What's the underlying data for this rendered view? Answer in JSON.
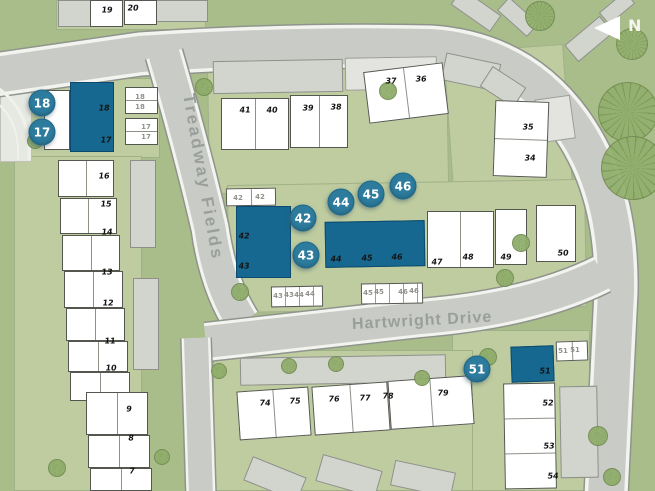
{
  "map": {
    "north": {
      "label": "N"
    },
    "colors": {
      "highlight_plot": "#176890",
      "badge": "#2d7c9e",
      "road": "#c9cbc6",
      "open_green": "#a8bd89",
      "parcel_green": "#becca0",
      "building_white": "#ffffff",
      "building_gray": "#d2d4ce"
    },
    "streets": [
      {
        "name": "Treadway Fields",
        "x": 188,
        "y": 84,
        "rotate": 80,
        "cls": "st-vert"
      },
      {
        "name": "Hartwright Drive",
        "x": 352,
        "y": 316,
        "rotate": -3,
        "cls": "st-horiz"
      }
    ],
    "badges": [
      {
        "label": "18",
        "x": 42,
        "y": 103
      },
      {
        "label": "17",
        "x": 42,
        "y": 132
      },
      {
        "label": "42",
        "x": 303,
        "y": 218
      },
      {
        "label": "43",
        "x": 306,
        "y": 255
      },
      {
        "label": "44",
        "x": 341,
        "y": 202
      },
      {
        "label": "45",
        "x": 371,
        "y": 194
      },
      {
        "label": "46",
        "x": 403,
        "y": 186
      },
      {
        "label": "51",
        "x": 477,
        "y": 369
      }
    ],
    "plot_labels": [
      {
        "label": "19",
        "x": 107,
        "y": 10
      },
      {
        "label": "20",
        "x": 133,
        "y": 8
      },
      {
        "label": "18",
        "x": 104,
        "y": 108
      },
      {
        "label": "17",
        "x": 106,
        "y": 140
      },
      {
        "label": "16",
        "x": 104,
        "y": 176
      },
      {
        "label": "15",
        "x": 106,
        "y": 204
      },
      {
        "label": "14",
        "x": 107,
        "y": 232
      },
      {
        "label": "13",
        "x": 107,
        "y": 272
      },
      {
        "label": "12",
        "x": 108,
        "y": 303
      },
      {
        "label": "11",
        "x": 110,
        "y": 341
      },
      {
        "label": "10",
        "x": 111,
        "y": 368
      },
      {
        "label": "9",
        "x": 129,
        "y": 409
      },
      {
        "label": "8",
        "x": 131,
        "y": 438
      },
      {
        "label": "7",
        "x": 132,
        "y": 471
      },
      {
        "label": "41",
        "x": 245,
        "y": 110
      },
      {
        "label": "40",
        "x": 272,
        "y": 110
      },
      {
        "label": "39",
        "x": 308,
        "y": 108
      },
      {
        "label": "38",
        "x": 336,
        "y": 107
      },
      {
        "label": "37",
        "x": 391,
        "y": 81
      },
      {
        "label": "36",
        "x": 421,
        "y": 79
      },
      {
        "label": "35",
        "x": 528,
        "y": 127
      },
      {
        "label": "34",
        "x": 530,
        "y": 158
      },
      {
        "label": "42",
        "x": 244,
        "y": 236
      },
      {
        "label": "43",
        "x": 244,
        "y": 266
      },
      {
        "label": "44",
        "x": 336,
        "y": 259
      },
      {
        "label": "45",
        "x": 367,
        "y": 258
      },
      {
        "label": "46",
        "x": 397,
        "y": 257
      },
      {
        "label": "47",
        "x": 437,
        "y": 262
      },
      {
        "label": "48",
        "x": 468,
        "y": 257
      },
      {
        "label": "49",
        "x": 506,
        "y": 257
      },
      {
        "label": "50",
        "x": 563,
        "y": 253
      },
      {
        "label": "74",
        "x": 265,
        "y": 403
      },
      {
        "label": "75",
        "x": 295,
        "y": 401
      },
      {
        "label": "76",
        "x": 334,
        "y": 399
      },
      {
        "label": "77",
        "x": 365,
        "y": 398
      },
      {
        "label": "78",
        "x": 388,
        "y": 396
      },
      {
        "label": "79",
        "x": 443,
        "y": 393
      },
      {
        "label": "51",
        "x": 545,
        "y": 371
      },
      {
        "label": "52",
        "x": 548,
        "y": 403
      },
      {
        "label": "53",
        "x": 549,
        "y": 446
      },
      {
        "label": "54",
        "x": 553,
        "y": 476
      }
    ],
    "garage_labels": [
      {
        "label": "18",
        "x": 140,
        "y": 97
      },
      {
        "label": "18",
        "x": 140,
        "y": 107
      },
      {
        "label": "17",
        "x": 146,
        "y": 127
      },
      {
        "label": "17",
        "x": 146,
        "y": 137
      },
      {
        "label": "42",
        "x": 238,
        "y": 198
      },
      {
        "label": "42",
        "x": 260,
        "y": 197
      },
      {
        "label": "43",
        "x": 278,
        "y": 296
      },
      {
        "label": "43",
        "x": 289,
        "y": 295
      },
      {
        "label": "44",
        "x": 299,
        "y": 295
      },
      {
        "label": "44",
        "x": 310,
        "y": 294
      },
      {
        "label": "45",
        "x": 368,
        "y": 293
      },
      {
        "label": "45",
        "x": 379,
        "y": 292
      },
      {
        "label": "46",
        "x": 403,
        "y": 292
      },
      {
        "label": "46",
        "x": 414,
        "y": 291
      },
      {
        "label": "51",
        "x": 563,
        "y": 351
      },
      {
        "label": "51",
        "x": 575,
        "y": 350
      }
    ],
    "greens": [
      {
        "x": 56,
        "y": 0,
        "w": 150,
        "h": 30
      },
      {
        "x": 28,
        "y": 78,
        "w": 132,
        "h": 80
      },
      {
        "x": 14,
        "y": 156,
        "w": 128,
        "h": 335
      },
      {
        "x": 208,
        "y": 55,
        "w": 240,
        "h": 137,
        "rotate": -1
      },
      {
        "x": 448,
        "y": 48,
        "w": 120,
        "h": 138,
        "rotate": -4
      },
      {
        "x": 228,
        "y": 182,
        "w": 358,
        "h": 128,
        "rotate": -1
      },
      {
        "x": 452,
        "y": 330,
        "w": 138,
        "h": 161
      },
      {
        "x": 213,
        "y": 350,
        "w": 260,
        "h": 141
      },
      {
        "x": 0,
        "y": 90,
        "w": 32,
        "h": 72,
        "cls": "pale"
      }
    ],
    "buildings": [
      {
        "x": 58,
        "y": 0,
        "w": 34,
        "h": 27,
        "cls": "b-gray"
      },
      {
        "x": 154,
        "y": 0,
        "w": 54,
        "h": 22,
        "cls": "b-gray"
      },
      {
        "x": 213,
        "y": 60,
        "w": 130,
        "h": 33,
        "rotate": -1,
        "cls": "b-gray stripes-v"
      },
      {
        "x": 345,
        "y": 57,
        "w": 92,
        "h": 33,
        "rotate": -1,
        "cls": "b-light stripes-v"
      },
      {
        "x": 452,
        "y": 0,
        "w": 48,
        "h": 20,
        "rotate": 35,
        "cls": "b-gray"
      },
      {
        "x": 498,
        "y": 8,
        "w": 40,
        "h": 18,
        "rotate": 42,
        "cls": "b-gray"
      },
      {
        "x": 443,
        "y": 58,
        "w": 56,
        "h": 28,
        "rotate": 12,
        "cls": "b-gray stripes-v"
      },
      {
        "x": 483,
        "y": 75,
        "w": 40,
        "h": 24,
        "rotate": 33,
        "cls": "b-gray"
      },
      {
        "x": 566,
        "y": 28,
        "w": 46,
        "h": 22,
        "rotate": -40,
        "cls": "b-gray"
      },
      {
        "x": 600,
        "y": 0,
        "w": 34,
        "h": 16,
        "rotate": -40,
        "cls": "b-gray"
      },
      {
        "x": 537,
        "y": 97,
        "w": 36,
        "h": 44,
        "rotate": -8,
        "cls": "b-light"
      },
      {
        "x": 130,
        "y": 160,
        "w": 26,
        "h": 88,
        "cls": "b-gray stripes-h"
      },
      {
        "x": 133,
        "y": 278,
        "w": 26,
        "h": 92,
        "cls": "b-gray stripes-h"
      },
      {
        "x": 240,
        "y": 356,
        "w": 206,
        "h": 28,
        "rotate": -1,
        "cls": "b-gray stripes-v"
      },
      {
        "x": 560,
        "y": 386,
        "w": 38,
        "h": 92,
        "rotate": -1,
        "cls": "b-gray stripes-h"
      },
      {
        "x": 246,
        "y": 466,
        "w": 58,
        "h": 26,
        "rotate": 22,
        "cls": "b-gray"
      },
      {
        "x": 318,
        "y": 462,
        "w": 62,
        "h": 28,
        "rotate": 16,
        "cls": "b-gray"
      },
      {
        "x": 392,
        "y": 466,
        "w": 62,
        "h": 26,
        "rotate": 12,
        "cls": "b-gray"
      },
      {
        "x": 90,
        "y": 0,
        "w": 33,
        "h": 27
      },
      {
        "x": 124,
        "y": 0,
        "w": 33,
        "h": 25
      },
      {
        "x": 125,
        "y": 87,
        "w": 33,
        "h": 27,
        "cls": "divy"
      },
      {
        "x": 125,
        "y": 118,
        "w": 33,
        "h": 27,
        "cls": "divy"
      },
      {
        "x": 44,
        "y": 90,
        "w": 26,
        "h": 60
      },
      {
        "x": 58,
        "y": 160,
        "w": 56,
        "h": 37,
        "cls": "divx"
      },
      {
        "x": 60,
        "y": 198,
        "w": 57,
        "h": 36,
        "cls": "divx"
      },
      {
        "x": 62,
        "y": 235,
        "w": 58,
        "h": 36,
        "cls": "divx"
      },
      {
        "x": 64,
        "y": 271,
        "w": 59,
        "h": 37,
        "cls": "divx"
      },
      {
        "x": 66,
        "y": 308,
        "w": 59,
        "h": 33,
        "cls": "divx"
      },
      {
        "x": 68,
        "y": 341,
        "w": 60,
        "h": 31,
        "cls": "divx"
      },
      {
        "x": 70,
        "y": 372,
        "w": 60,
        "h": 29,
        "cls": "divx"
      },
      {
        "x": 86,
        "y": 392,
        "w": 62,
        "h": 43,
        "cls": "divx"
      },
      {
        "x": 88,
        "y": 435,
        "w": 62,
        "h": 33,
        "cls": "divx"
      },
      {
        "x": 90,
        "y": 468,
        "w": 62,
        "h": 23,
        "cls": "divx"
      },
      {
        "x": 221,
        "y": 98,
        "w": 68,
        "h": 52,
        "cls": "divx"
      },
      {
        "x": 290,
        "y": 95,
        "w": 58,
        "h": 53,
        "cls": "divx"
      },
      {
        "x": 366,
        "y": 67,
        "w": 80,
        "h": 52,
        "rotate": -7,
        "cls": "divx"
      },
      {
        "x": 494,
        "y": 101,
        "w": 54,
        "h": 76,
        "rotate": 2,
        "cls": "divy"
      },
      {
        "x": 427,
        "y": 211,
        "w": 67,
        "h": 57,
        "cls": "divx"
      },
      {
        "x": 495,
        "y": 209,
        "w": 32,
        "h": 56
      },
      {
        "x": 536,
        "y": 205,
        "w": 40,
        "h": 57
      },
      {
        "x": 226,
        "y": 188,
        "w": 50,
        "h": 18,
        "rotate": -1,
        "cls": "divx"
      },
      {
        "x": 271,
        "y": 286,
        "w": 52,
        "h": 21,
        "rotate": -1,
        "cls": "stripes-v"
      },
      {
        "x": 361,
        "y": 283,
        "w": 62,
        "h": 21,
        "rotate": -1,
        "cls": "stripes-v"
      },
      {
        "x": 238,
        "y": 389,
        "w": 72,
        "h": 49,
        "rotate": -4,
        "cls": "divx"
      },
      {
        "x": 313,
        "y": 384,
        "w": 76,
        "h": 49,
        "rotate": -4,
        "cls": "divx"
      },
      {
        "x": 389,
        "y": 378,
        "w": 84,
        "h": 49,
        "rotate": -4,
        "cls": "divx"
      },
      {
        "x": 556,
        "y": 341,
        "w": 32,
        "h": 20,
        "rotate": -2,
        "cls": "divx"
      },
      {
        "x": 504,
        "y": 383,
        "w": 52,
        "h": 106,
        "rotate": -1,
        "cls": "split3"
      },
      {
        "x": 70,
        "y": 82,
        "w": 44,
        "h": 70,
        "cls": "b-teal divy-t"
      },
      {
        "x": 236,
        "y": 206,
        "w": 55,
        "h": 72,
        "cls": "b-teal divy-t"
      },
      {
        "x": 325,
        "y": 221,
        "w": 100,
        "h": 46,
        "rotate": -1,
        "cls": "b-teal divx3"
      },
      {
        "x": 511,
        "y": 346,
        "w": 43,
        "h": 36,
        "rotate": -2,
        "cls": "b-teal"
      }
    ],
    "trees": [
      {
        "x": 598,
        "y": 82,
        "w": 60,
        "h": 60
      },
      {
        "x": 601,
        "y": 136,
        "w": 64,
        "h": 64
      },
      {
        "x": 525,
        "y": 1,
        "w": 30,
        "h": 30
      },
      {
        "x": 616,
        "y": 28,
        "w": 32,
        "h": 32
      },
      {
        "x": 195,
        "y": 78,
        "w": 18,
        "h": 18
      },
      {
        "x": 379,
        "y": 82,
        "w": 18,
        "h": 18
      },
      {
        "x": 27,
        "y": 133,
        "w": 16,
        "h": 16
      },
      {
        "x": 231,
        "y": 283,
        "w": 18,
        "h": 18
      },
      {
        "x": 512,
        "y": 234,
        "w": 18,
        "h": 18
      },
      {
        "x": 496,
        "y": 269,
        "w": 18,
        "h": 18
      },
      {
        "x": 479,
        "y": 348,
        "w": 18,
        "h": 18
      },
      {
        "x": 414,
        "y": 370,
        "w": 16,
        "h": 16
      },
      {
        "x": 211,
        "y": 363,
        "w": 16,
        "h": 16
      },
      {
        "x": 281,
        "y": 358,
        "w": 16,
        "h": 16
      },
      {
        "x": 328,
        "y": 356,
        "w": 16,
        "h": 16
      },
      {
        "x": 154,
        "y": 449,
        "w": 16,
        "h": 16
      },
      {
        "x": 588,
        "y": 426,
        "w": 20,
        "h": 20
      },
      {
        "x": 603,
        "y": 468,
        "w": 18,
        "h": 18
      },
      {
        "x": 48,
        "y": 459,
        "w": 18,
        "h": 18
      }
    ]
  }
}
